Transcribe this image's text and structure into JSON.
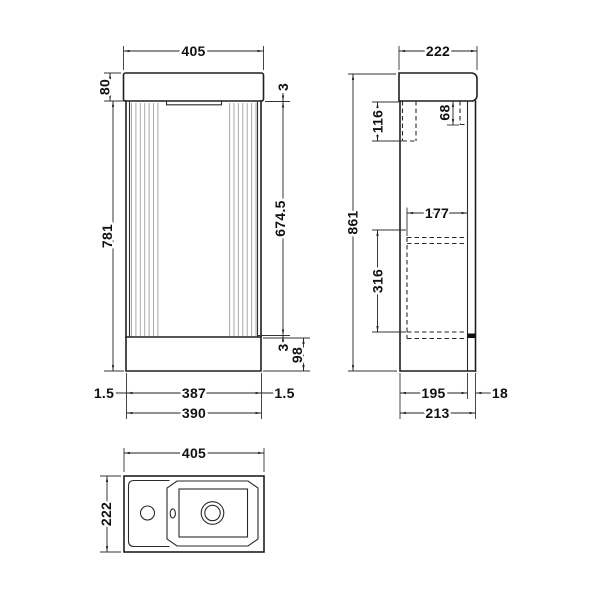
{
  "front": {
    "overall_width": "405",
    "worktop_height": "80",
    "cabinet_height": "781",
    "top_gap": "3",
    "door_height": "674.5",
    "bottom_gap": "3",
    "plinth_height": "98",
    "side_panel_left": "1.5",
    "internal_width": "387",
    "side_panel_right": "1.5",
    "cabinet_width": "390"
  },
  "side": {
    "overall_depth": "222",
    "overall_height": "861",
    "back_rail_height": "116",
    "front_rail_height": "68",
    "shelf_depth": "177",
    "shelf_clearance": "316",
    "carcass_depth": "195",
    "door_thickness": "18",
    "base_depth": "213"
  },
  "plan": {
    "overall_width": "405",
    "overall_depth": "222"
  }
}
